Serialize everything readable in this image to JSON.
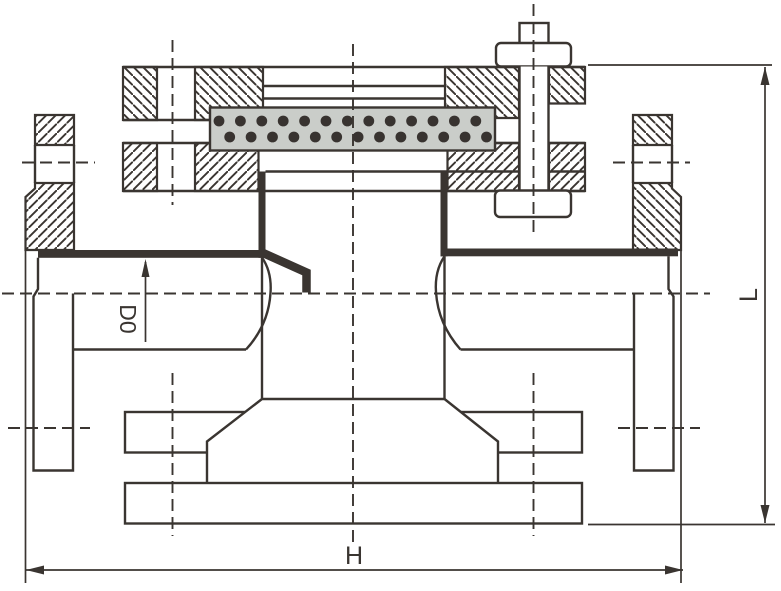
{
  "labels": {
    "bore_dimension": "D0",
    "width_dimension": "H",
    "height_dimension": "L"
  },
  "colors": {
    "line": "#3a3531",
    "gasket_fill": "#cacdc9",
    "dot": "#383330",
    "background": "#ffffff"
  },
  "gasket_dots": {
    "row1_y": 121,
    "row2_y": 137,
    "x_start": 219,
    "row2_offset": 10.7,
    "x_step": 21.4,
    "count_per_row": 13,
    "radius": 5.4
  }
}
